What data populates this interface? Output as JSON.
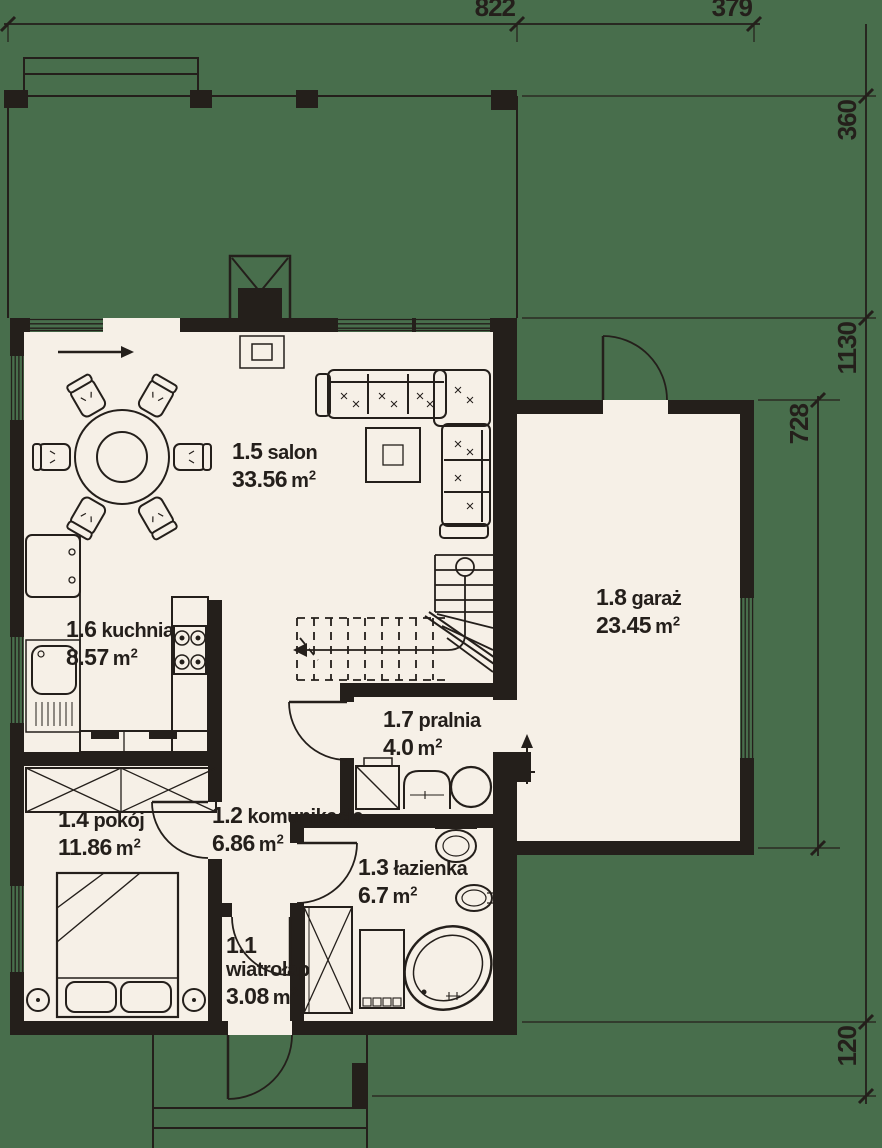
{
  "plan": {
    "colors": {
      "background": "#486e4c",
      "floor": "#f6f0e7",
      "wall": "#241f1b"
    },
    "unit": {
      "m": "m",
      "sup": "2"
    },
    "rooms": {
      "wiatrolap": {
        "id": "1.1",
        "name": "wiatrołap",
        "area": "3.08"
      },
      "komunikacja": {
        "id": "1.2",
        "name": "komunikacja",
        "area": "6.86"
      },
      "lazienka": {
        "id": "1.3",
        "name": "łazienka",
        "area": "6.7"
      },
      "pokoj": {
        "id": "1.4",
        "name": "pokój",
        "area": "11.86"
      },
      "salon": {
        "id": "1.5",
        "name": "salon",
        "area": "33.56"
      },
      "kuchnia": {
        "id": "1.6",
        "name": "kuchnia",
        "area": "8.57"
      },
      "pralnia": {
        "id": "1.7",
        "name": "pralnia",
        "area": "4.0"
      },
      "garaz": {
        "id": "1.8",
        "name": "garaż",
        "area": "23.45"
      }
    },
    "dimensions": {
      "top": {
        "a": "822",
        "b": "379"
      },
      "right": {
        "a": "360",
        "b": "1130",
        "c": "120"
      },
      "inner": {
        "a": "728"
      }
    },
    "fixtures": [
      "dining-table",
      "chairs",
      "corner-sofa",
      "coffee-table",
      "fireplace",
      "fridge",
      "kitchen-sink",
      "stove",
      "counter",
      "stairs",
      "bed",
      "pillows",
      "wardrobe",
      "closet",
      "washing-machine",
      "laundry-sink",
      "boiler",
      "toilet",
      "washbasin",
      "corner-bathtub",
      "radiator",
      "entrance-steps",
      "door-arcs",
      "windows"
    ]
  }
}
